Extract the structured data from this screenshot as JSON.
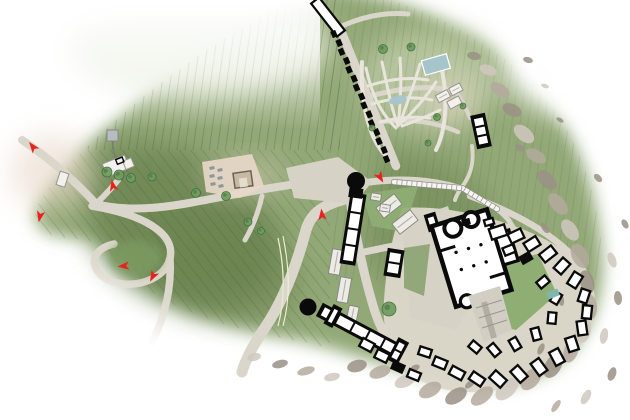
{
  "canvas": {
    "width": 630,
    "height": 420,
    "background": "#ffffff"
  },
  "palette": {
    "hill_base": "#93a877",
    "hill_dark": "#67814e",
    "hill_light": "#b9c8a2",
    "hill_pale": "#e4ead8",
    "contour": "#3f5535",
    "road": "#dbd6cb",
    "road_light": "#e9e5dc",
    "plaza": "#d7d2c6",
    "warm": "#e9d8c9",
    "village_ground": "#dcd7cb",
    "wall": "#0a0a0a",
    "floor": "#ffffff",
    "slab_fill": "#ecebe6",
    "slab_edge": "#85837e",
    "water": "#a5c4cc",
    "water_teal": "#7fb7b0",
    "rock_a": "#b4a99e",
    "rock_b": "#cfc8be",
    "rock_c": "#9a9085",
    "red": "#e8231d",
    "tree": "#6f9c5e",
    "tree_dark": "#3f6d3c",
    "grass": "#8fae74",
    "grass_dark": "#7b9a60",
    "tan_building": "#c7b9a2",
    "tan_edge": "#6f6152"
  },
  "map": {
    "arrows": [
      [
        33,
        147,
        -38
      ],
      [
        113,
        186,
        -12
      ],
      [
        40,
        216,
        192
      ],
      [
        124,
        266,
        -95
      ],
      [
        153,
        276,
        208
      ],
      [
        380,
        177,
        150
      ],
      [
        322,
        215,
        -6
      ]
    ],
    "trees": [
      [
        107,
        172,
        5,
        0
      ],
      [
        119,
        175,
        5,
        0
      ],
      [
        131,
        178,
        4.5,
        0
      ],
      [
        152,
        177,
        4,
        0
      ],
      [
        196,
        193,
        4.5,
        0
      ],
      [
        226,
        196,
        4.5,
        0
      ],
      [
        248,
        222,
        4,
        0
      ],
      [
        261,
        231,
        3.5,
        0
      ],
      [
        383,
        49,
        4.5,
        0
      ],
      [
        411,
        47,
        4,
        0
      ],
      [
        437,
        117,
        3.5,
        0
      ],
      [
        463,
        106,
        3,
        0
      ],
      [
        372,
        128,
        3,
        0
      ],
      [
        428,
        143,
        3,
        0
      ],
      [
        389,
        309,
        7,
        1
      ]
    ],
    "cells": {
      "x": 334,
      "y": 34,
      "dx": 3.75,
      "dy": 8.93,
      "count": 15,
      "rot": 67,
      "w": 6.8,
      "h": 5.4
    },
    "wings": [
      [
        481,
        131,
        15,
        34,
        -12,
        3
      ],
      [
        353,
        229,
        16,
        72,
        9,
        4
      ],
      [
        394,
        263,
        17,
        28,
        9,
        2
      ],
      [
        360,
        331,
        92,
        15,
        28,
        5
      ],
      [
        333,
        316,
        10,
        22,
        28,
        1
      ],
      [
        398,
        351,
        12,
        25,
        28,
        2
      ],
      [
        432,
        222,
        12,
        18,
        -17,
        1
      ]
    ],
    "slabs": [
      [
        389,
        206,
        23,
        13,
        -38
      ],
      [
        405,
        222,
        23,
        13,
        -38
      ],
      [
        336,
        262,
        11,
        25,
        10
      ],
      [
        344,
        290,
        11,
        25,
        10
      ],
      [
        376,
        197,
        10,
        7,
        9
      ],
      [
        385,
        208,
        10,
        7,
        9
      ],
      [
        352,
        317,
        10,
        22,
        12
      ]
    ],
    "blocks": [
      [
        498,
        232,
        16,
        11,
        -18,
        0
      ],
      [
        516,
        236,
        14,
        10,
        -25,
        0
      ],
      [
        532,
        244,
        14,
        10,
        -32,
        0
      ],
      [
        548,
        254,
        15,
        10,
        -38,
        0
      ],
      [
        562,
        266,
        14,
        10,
        -48,
        0
      ],
      [
        575,
        280,
        14,
        10,
        -58,
        0
      ],
      [
        584,
        296,
        13,
        9,
        -72,
        0
      ],
      [
        587,
        312,
        13,
        9,
        -84,
        0
      ],
      [
        582,
        328,
        14,
        9,
        -98,
        0
      ],
      [
        572,
        344,
        14,
        10,
        -108,
        0
      ],
      [
        557,
        357,
        15,
        10,
        -118,
        0
      ],
      [
        539,
        367,
        15,
        10,
        -126,
        0
      ],
      [
        519,
        374,
        15,
        10,
        -132,
        0
      ],
      [
        498,
        379,
        15,
        10,
        -138,
        0
      ],
      [
        477,
        379,
        14,
        9,
        -146,
        0
      ],
      [
        457,
        373,
        14,
        9,
        -152,
        0
      ],
      [
        440,
        363,
        13,
        9,
        -158,
        0
      ],
      [
        425,
        352,
        12,
        8,
        -162,
        0
      ],
      [
        543,
        282,
        11,
        8,
        -40,
        0
      ],
      [
        556,
        298,
        11,
        8,
        -60,
        0
      ],
      [
        552,
        318,
        11,
        8,
        -85,
        0
      ],
      [
        536,
        334,
        12,
        8,
        -105,
        0
      ],
      [
        515,
        344,
        12,
        8,
        -120,
        0
      ],
      [
        494,
        350,
        12,
        8,
        -130,
        0
      ],
      [
        475,
        347,
        11,
        8,
        -140,
        0
      ],
      [
        509,
        250,
        11,
        8,
        -22,
        0
      ],
      [
        526,
        258,
        12,
        9,
        -30,
        1
      ],
      [
        466,
        222,
        8,
        6,
        -14,
        1
      ],
      [
        489,
        222,
        9,
        6,
        -16,
        0
      ],
      [
        367,
        345,
        13,
        9,
        28,
        0
      ],
      [
        382,
        356,
        13,
        9,
        26,
        0
      ],
      [
        398,
        367,
        13,
        9,
        24,
        1
      ],
      [
        414,
        375,
        12,
        8,
        22,
        0
      ]
    ],
    "rocks": [
      [
        488,
        70,
        9,
        5,
        20,
        1
      ],
      [
        474,
        56,
        7,
        4,
        10,
        2
      ],
      [
        500,
        90,
        11,
        6,
        35,
        0
      ],
      [
        512,
        110,
        10,
        6,
        25,
        2
      ],
      [
        524,
        134,
        12,
        7,
        40,
        1
      ],
      [
        536,
        156,
        11,
        6,
        30,
        0
      ],
      [
        547,
        180,
        12,
        7,
        45,
        2
      ],
      [
        558,
        204,
        13,
        7,
        50,
        0
      ],
      [
        570,
        230,
        12,
        7,
        55,
        1
      ],
      [
        580,
        256,
        13,
        8,
        62,
        0
      ],
      [
        587,
        282,
        12,
        7,
        74,
        2
      ],
      [
        589,
        307,
        13,
        8,
        86,
        0
      ],
      [
        583,
        330,
        13,
        8,
        100,
        1
      ],
      [
        571,
        351,
        12,
        7,
        110,
        0
      ],
      [
        553,
        366,
        13,
        8,
        120,
        2
      ],
      [
        531,
        379,
        13,
        8,
        130,
        0
      ],
      [
        507,
        389,
        14,
        8,
        136,
        1
      ],
      [
        482,
        396,
        13,
        7,
        142,
        0
      ],
      [
        456,
        396,
        12,
        7,
        148,
        2
      ],
      [
        430,
        390,
        12,
        7,
        152,
        0
      ],
      [
        405,
        381,
        11,
        6,
        156,
        1
      ],
      [
        380,
        372,
        11,
        6,
        160,
        0
      ],
      [
        357,
        366,
        10,
        6,
        165,
        2
      ],
      [
        332,
        377,
        8,
        4,
        168,
        1
      ],
      [
        306,
        371,
        9,
        4,
        164,
        0
      ],
      [
        280,
        364,
        8,
        4,
        166,
        2
      ],
      [
        254,
        357,
        7,
        4,
        168,
        1
      ],
      [
        520,
        148,
        5,
        3,
        30,
        2
      ],
      [
        545,
        228,
        6,
        3,
        55,
        2
      ],
      [
        561,
        300,
        6,
        3,
        80,
        2
      ],
      [
        541,
        349,
        6,
        3,
        115,
        2
      ],
      [
        470,
        384,
        6,
        3,
        140,
        2
      ],
      [
        415,
        368,
        5,
        3,
        155,
        2
      ],
      [
        612,
        260,
        8,
        4,
        70,
        1
      ],
      [
        618,
        298,
        7,
        4,
        85,
        2
      ],
      [
        604,
        336,
        8,
        4,
        100,
        1
      ],
      [
        612,
        374,
        7,
        4,
        110,
        2
      ],
      [
        586,
        397,
        8,
        4,
        120,
        1
      ],
      [
        625,
        224,
        5,
        3,
        60,
        2
      ],
      [
        556,
        406,
        7,
        3,
        125,
        0
      ],
      [
        598,
        178,
        5,
        3,
        45,
        2
      ],
      [
        528,
        60,
        5,
        3,
        15,
        2
      ],
      [
        545,
        86,
        4,
        2,
        20,
        1
      ],
      [
        560,
        120,
        4,
        2,
        30,
        2
      ]
    ],
    "cars": [
      [
        212,
        168
      ],
      [
        220,
        170
      ],
      [
        212,
        176
      ],
      [
        220,
        178
      ],
      [
        213,
        184
      ],
      [
        221,
        186
      ]
    ],
    "funicular": {
      "points": [
        [
          394,
          182
        ],
        [
          462,
          188
        ],
        [
          497,
          209
        ]
      ],
      "tick_step": 5
    }
  }
}
